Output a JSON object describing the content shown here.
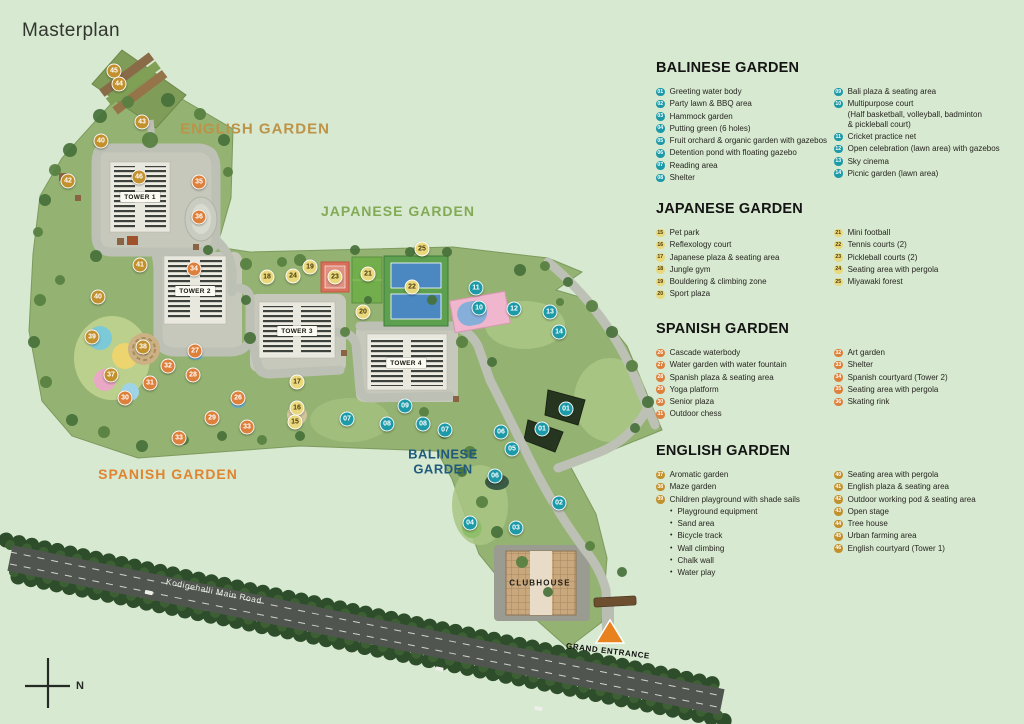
{
  "title": "Masterplan",
  "compass_label": "N",
  "colors": {
    "background": "#d7e9d1",
    "balinese_badge": "#1d9aa8",
    "japanese_badge": "#ead87c",
    "japanese_badge_text": "#4a3c12",
    "spanish_badge": "#dd803c",
    "english_badge": "#c2912e",
    "balinese_label": "#1f5a7d",
    "japanese_label": "#83aa55",
    "spanish_label": "#e08430",
    "english_label": "#bd9348",
    "entrance_triangle": "#e8821e"
  },
  "map": {
    "garden_labels": [
      {
        "id": "english",
        "text": "ENGLISH GARDEN",
        "x": 255,
        "y": 130,
        "color_key": "english_label",
        "size": 15,
        "ls": 1
      },
      {
        "id": "japanese",
        "text": "JAPANESE GARDEN",
        "x": 398,
        "y": 212,
        "color_key": "japanese_label",
        "size": 14,
        "ls": 1
      },
      {
        "id": "spanish",
        "text": "SPANISH GARDEN",
        "x": 168,
        "y": 475,
        "color_key": "spanish_label",
        "size": 14,
        "ls": 1
      },
      {
        "id": "balinese",
        "text": "BALINESE\nGARDEN",
        "x": 443,
        "y": 462,
        "color_key": "balinese_label",
        "size": 13,
        "ls": 0.5
      }
    ],
    "place_labels": [
      {
        "id": "tower-1",
        "text": "TOWER 1",
        "x": 140,
        "y": 197,
        "style": "tower",
        "rot": 0
      },
      {
        "id": "tower-2",
        "text": "TOWER 2",
        "x": 195,
        "y": 291,
        "style": "tower",
        "rot": 0
      },
      {
        "id": "tower-3",
        "text": "TOWER 3",
        "x": 297,
        "y": 331,
        "style": "tower",
        "rot": 0
      },
      {
        "id": "tower-4",
        "text": "TOWER 4",
        "x": 406,
        "y": 363,
        "style": "tower",
        "rot": 0
      },
      {
        "id": "clubhouse",
        "text": "CLUBHOUSE",
        "x": 540,
        "y": 583,
        "style": "clubhouse",
        "rot": 0
      },
      {
        "id": "grand-entrance",
        "text": "GRAND ENTRANCE",
        "x": 608,
        "y": 651,
        "style": "entrance",
        "rot": 7
      },
      {
        "id": "road-name",
        "text": "Kodigehalli Main Road",
        "x": 214,
        "y": 591,
        "style": "road",
        "rot": 11.5
      }
    ],
    "markers": [
      {
        "n": "45",
        "g": "english",
        "x": 114,
        "y": 71
      },
      {
        "n": "44",
        "g": "english",
        "x": 119,
        "y": 84
      },
      {
        "n": "43",
        "g": "english",
        "x": 142,
        "y": 122
      },
      {
        "n": "40",
        "g": "english",
        "x": 101,
        "y": 141
      },
      {
        "n": "46",
        "g": "english",
        "x": 139,
        "y": 177
      },
      {
        "n": "42",
        "g": "english",
        "x": 68,
        "y": 181
      },
      {
        "n": "41",
        "g": "english",
        "x": 140,
        "y": 265
      },
      {
        "n": "40",
        "g": "english",
        "x": 98,
        "y": 297
      },
      {
        "n": "39",
        "g": "english",
        "x": 92,
        "y": 337
      },
      {
        "n": "38",
        "g": "english",
        "x": 143,
        "y": 347
      },
      {
        "n": "37",
        "g": "english",
        "x": 111,
        "y": 375
      },
      {
        "n": "35",
        "g": "spanish",
        "x": 199,
        "y": 182
      },
      {
        "n": "36",
        "g": "spanish",
        "x": 199,
        "y": 217
      },
      {
        "n": "34",
        "g": "spanish",
        "x": 194,
        "y": 269
      },
      {
        "n": "27",
        "g": "spanish",
        "x": 195,
        "y": 351
      },
      {
        "n": "32",
        "g": "spanish",
        "x": 168,
        "y": 366
      },
      {
        "n": "28",
        "g": "spanish",
        "x": 193,
        "y": 375
      },
      {
        "n": "31",
        "g": "spanish",
        "x": 150,
        "y": 383
      },
      {
        "n": "30",
        "g": "spanish",
        "x": 125,
        "y": 398
      },
      {
        "n": "26",
        "g": "spanish",
        "x": 238,
        "y": 398
      },
      {
        "n": "29",
        "g": "spanish",
        "x": 212,
        "y": 418
      },
      {
        "n": "33",
        "g": "spanish",
        "x": 247,
        "y": 427
      },
      {
        "n": "33",
        "g": "spanish",
        "x": 179,
        "y": 438
      },
      {
        "n": "18",
        "g": "japanese",
        "x": 267,
        "y": 277
      },
      {
        "n": "24",
        "g": "japanese",
        "x": 293,
        "y": 276
      },
      {
        "n": "19",
        "g": "japanese",
        "x": 310,
        "y": 267
      },
      {
        "n": "23",
        "g": "japanese",
        "x": 335,
        "y": 277
      },
      {
        "n": "21",
        "g": "japanese",
        "x": 368,
        "y": 274
      },
      {
        "n": "25",
        "g": "japanese",
        "x": 422,
        "y": 249
      },
      {
        "n": "22",
        "g": "japanese",
        "x": 412,
        "y": 287
      },
      {
        "n": "20",
        "g": "japanese",
        "x": 363,
        "y": 312
      },
      {
        "n": "17",
        "g": "japanese",
        "x": 297,
        "y": 382
      },
      {
        "n": "16",
        "g": "japanese",
        "x": 297,
        "y": 408
      },
      {
        "n": "15",
        "g": "japanese",
        "x": 295,
        "y": 422
      },
      {
        "n": "11",
        "g": "balinese",
        "x": 476,
        "y": 288
      },
      {
        "n": "10",
        "g": "balinese",
        "x": 479,
        "y": 308
      },
      {
        "n": "12",
        "g": "balinese",
        "x": 514,
        "y": 309
      },
      {
        "n": "13",
        "g": "balinese",
        "x": 550,
        "y": 312
      },
      {
        "n": "14",
        "g": "balinese",
        "x": 559,
        "y": 332
      },
      {
        "n": "01",
        "g": "balinese",
        "x": 566,
        "y": 409
      },
      {
        "n": "01",
        "g": "balinese",
        "x": 542,
        "y": 429
      },
      {
        "n": "07",
        "g": "balinese",
        "x": 347,
        "y": 419
      },
      {
        "n": "09",
        "g": "balinese",
        "x": 405,
        "y": 406
      },
      {
        "n": "08",
        "g": "balinese",
        "x": 387,
        "y": 424
      },
      {
        "n": "08",
        "g": "balinese",
        "x": 423,
        "y": 424
      },
      {
        "n": "07",
        "g": "balinese",
        "x": 445,
        "y": 430
      },
      {
        "n": "06",
        "g": "balinese",
        "x": 501,
        "y": 432
      },
      {
        "n": "05",
        "g": "balinese",
        "x": 512,
        "y": 449
      },
      {
        "n": "06",
        "g": "balinese",
        "x": 495,
        "y": 476
      },
      {
        "n": "02",
        "g": "balinese",
        "x": 559,
        "y": 503
      },
      {
        "n": "04",
        "g": "balinese",
        "x": 470,
        "y": 523
      },
      {
        "n": "03",
        "g": "balinese",
        "x": 516,
        "y": 528
      }
    ]
  },
  "legend": {
    "sections": [
      {
        "id": "balinese",
        "title": "BALINESE GARDEN",
        "top": 0,
        "columns": [
          [
            {
              "n": "01",
              "label": "Greeting water body"
            },
            {
              "n": "02",
              "label": "Party lawn & BBQ area"
            },
            {
              "n": "03",
              "label": "Hammock garden"
            },
            {
              "n": "04",
              "label": "Putting green (6 holes)"
            },
            {
              "n": "05",
              "label": "Fruit orchard & organic garden with gazebos"
            },
            {
              "n": "06",
              "label": "Detention pond with floating gazebo"
            },
            {
              "n": "07",
              "label": "Reading area"
            },
            {
              "n": "08",
              "label": "Shelter"
            }
          ],
          [
            {
              "n": "09",
              "label": "Bali plaza & seating area"
            },
            {
              "n": "10",
              "label": "Multipurpose court",
              "cont": [
                "(Half basketball, volleyball, badminton",
                "& pickleball court)"
              ]
            },
            {
              "n": "11",
              "label": "Cricket practice net"
            },
            {
              "n": "12",
              "label": "Open celebration (lawn area) with gazebos"
            },
            {
              "n": "13",
              "label": "Sky cinema"
            },
            {
              "n": "14",
              "label": "Picnic garden (lawn area)"
            }
          ]
        ]
      },
      {
        "id": "japanese",
        "title": "JAPANESE GARDEN",
        "top": 141,
        "columns": [
          [
            {
              "n": "15",
              "label": "Pet park"
            },
            {
              "n": "16",
              "label": "Reflexology court"
            },
            {
              "n": "17",
              "label": "Japanese plaza & seating area"
            },
            {
              "n": "18",
              "label": "Jungle gym"
            },
            {
              "n": "19",
              "label": "Bouldering & climbing zone"
            },
            {
              "n": "20",
              "label": "Sport plaza"
            }
          ],
          [
            {
              "n": "21",
              "label": "Mini football"
            },
            {
              "n": "22",
              "label": "Tennis courts (2)"
            },
            {
              "n": "23",
              "label": "Pickleball courts (2)"
            },
            {
              "n": "24",
              "label": "Seating area with pergola"
            },
            {
              "n": "25",
              "label": "Miyawaki forest"
            }
          ]
        ]
      },
      {
        "id": "spanish",
        "title": "SPANISH GARDEN",
        "top": 261,
        "columns": [
          [
            {
              "n": "26",
              "label": "Cascade waterbody"
            },
            {
              "n": "27",
              "label": "Water garden with water fountain"
            },
            {
              "n": "28",
              "label": "Spanish plaza & seating area"
            },
            {
              "n": "29",
              "label": "Yoga platform"
            },
            {
              "n": "30",
              "label": "Senior plaza"
            },
            {
              "n": "31",
              "label": "Outdoor chess"
            }
          ],
          [
            {
              "n": "32",
              "label": "Art garden"
            },
            {
              "n": "33",
              "label": "Shelter"
            },
            {
              "n": "34",
              "label": "Spanish courtyard (Tower 2)"
            },
            {
              "n": "35",
              "label": "Seating area with pergola"
            },
            {
              "n": "36",
              "label": "Skating rink"
            }
          ]
        ]
      },
      {
        "id": "english",
        "title": "ENGLISH GARDEN",
        "top": 383,
        "columns": [
          [
            {
              "n": "37",
              "label": "Aromatic garden"
            },
            {
              "n": "38",
              "label": "Maze garden"
            },
            {
              "n": "39",
              "label": "Children playground with shade sails",
              "sub": [
                "Playground equipment",
                "Sand area",
                "Bicycle track",
                "Wall climbing",
                "Chalk wall",
                "Water play"
              ]
            }
          ],
          [
            {
              "n": "40",
              "label": "Seating area with pergola"
            },
            {
              "n": "41",
              "label": "English plaza & seating area"
            },
            {
              "n": "42",
              "label": "Outdoor working pod & seating area"
            },
            {
              "n": "43",
              "label": "Open stage"
            },
            {
              "n": "44",
              "label": "Tree house"
            },
            {
              "n": "45",
              "label": "Urban farming area"
            },
            {
              "n": "46",
              "label": "English courtyard (Tower 1)"
            }
          ]
        ]
      }
    ]
  }
}
